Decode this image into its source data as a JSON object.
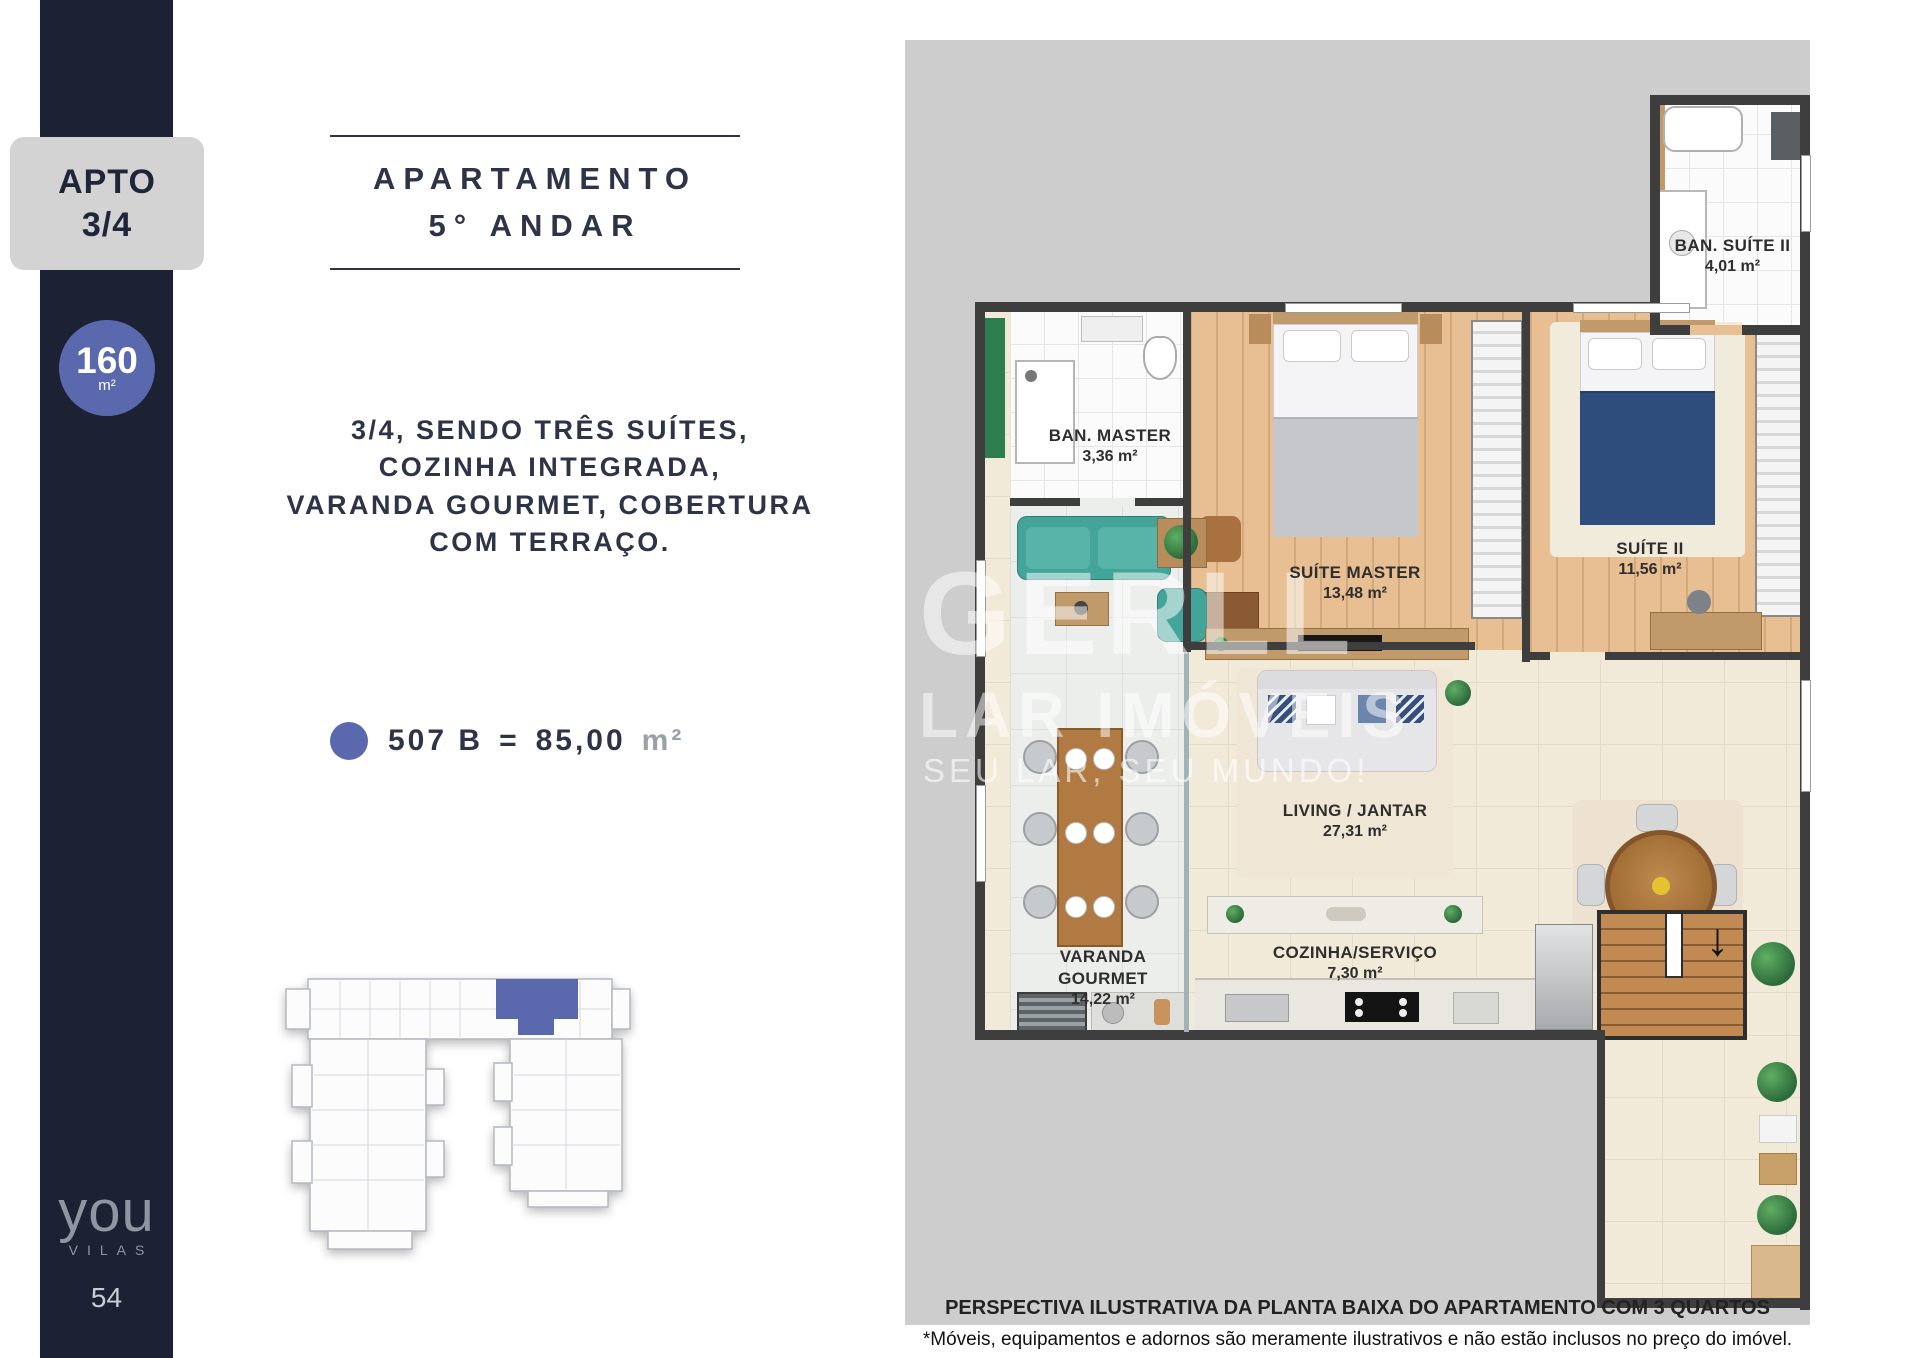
{
  "colors": {
    "navy": "#1c2133",
    "accent_blue": "#5a69ae",
    "badge_gray": "#d3d3d3",
    "plan_background": "#cdcdcd"
  },
  "sidebar": {
    "apto_line1": "APTO",
    "apto_line2": "3/4",
    "area_value": "160",
    "area_unit": "m²",
    "logo_main": "you",
    "logo_sub": "VILAS",
    "page_number": "54"
  },
  "header": {
    "title_line1": "APARTAMENTO",
    "title_line2": "5° ANDAR"
  },
  "description": {
    "line1": "3/4, SENDO TRÊS SUÍTES,",
    "line2": "COZINHA INTEGRADA,",
    "line3": "VARANDA GOURMET, COBERTURA",
    "line4": "COM TERRAÇO."
  },
  "legend": {
    "unit": "507 B",
    "equals": "=",
    "area": "85,00",
    "area_unit": "m²"
  },
  "floorplan": {
    "watermark_line1": "GERLL",
    "watermark_line2": "LAR IMÓVEIS",
    "watermark_line3": "SEU LAR, SEU MUNDO!",
    "rooms": [
      {
        "name": "BAN. SUÍTE II",
        "area": "4,01 m²"
      },
      {
        "name": "BAN. MASTER",
        "area": "3,36 m²"
      },
      {
        "name": "SUÍTE MASTER",
        "area": "13,48 m²"
      },
      {
        "name": "SUÍTE II",
        "area": "11,56 m²"
      },
      {
        "name": "LIVING / JANTAR",
        "area": "27,31 m²"
      },
      {
        "name": "VARANDA GOURMET",
        "area": "14,22 m²"
      },
      {
        "name": "COZINHA/SERVIÇO",
        "area": "7,30 m²"
      }
    ],
    "stairs_arrow": "↓",
    "caption_title": "PERSPECTIVA ILUSTRATIVA DA PLANTA BAIXA DO APARTAMENTO COM 3 QUARTOS",
    "caption_note": "*Móveis, equipamentos e adornos são meramente ilustrativos e não estão inclusos no preço do imóvel."
  }
}
